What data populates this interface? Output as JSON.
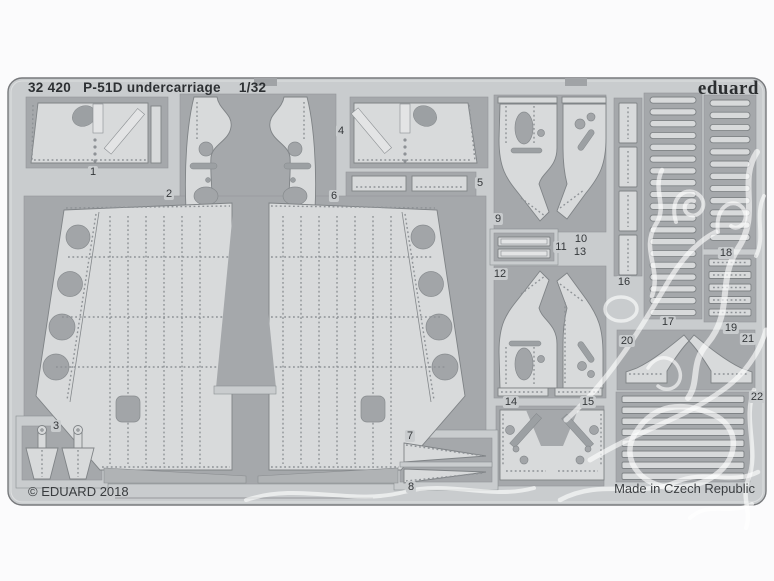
{
  "product": {
    "catalog_number": "32 420",
    "name": "P-51D undercarriage",
    "scale": "1/32",
    "brand": "eduard",
    "copyright": "© EDUARD 2018",
    "made_in": "Made in Czech Republic"
  },
  "sheet_description": "photo-etched metal fret with numbered parts",
  "colors": {
    "background": "#fbfbfc",
    "metal_light": "#c9ccce",
    "part_light": "#d8dadb",
    "recess_dark": "#a5a8ab",
    "text_dark": "#303336",
    "watermark": "rgba(255,255,255,0.62)"
  },
  "parts": [
    {
      "number": "1",
      "x": 93,
      "y": 172
    },
    {
      "number": "2",
      "x": 169,
      "y": 194
    },
    {
      "number": "3",
      "x": 56,
      "y": 426
    },
    {
      "number": "4",
      "x": 341,
      "y": 131
    },
    {
      "number": "5",
      "x": 480,
      "y": 183
    },
    {
      "number": "6",
      "x": 334,
      "y": 196
    },
    {
      "number": "7",
      "x": 410,
      "y": 436
    },
    {
      "number": "8",
      "x": 411,
      "y": 487
    },
    {
      "number": "9",
      "x": 498,
      "y": 219
    },
    {
      "number": "10",
      "x": 581,
      "y": 239
    },
    {
      "number": "11",
      "x": 561,
      "y": 247
    },
    {
      "number": "12",
      "x": 500,
      "y": 274
    },
    {
      "number": "13",
      "x": 580,
      "y": 252
    },
    {
      "number": "14",
      "x": 511,
      "y": 402
    },
    {
      "number": "15",
      "x": 588,
      "y": 402
    },
    {
      "number": "16",
      "x": 624,
      "y": 282
    },
    {
      "number": "17",
      "x": 668,
      "y": 322
    },
    {
      "number": "18",
      "x": 726,
      "y": 253
    },
    {
      "number": "19",
      "x": 731,
      "y": 328
    },
    {
      "number": "20",
      "x": 627,
      "y": 341
    },
    {
      "number": "21",
      "x": 748,
      "y": 339
    },
    {
      "number": "22",
      "x": 757,
      "y": 397
    }
  ]
}
